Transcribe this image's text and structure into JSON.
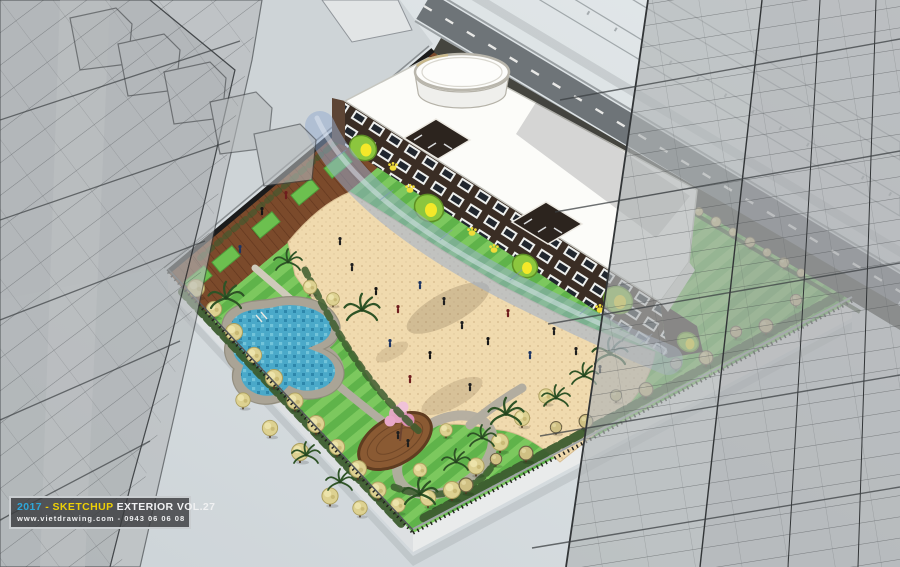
{
  "watermark": {
    "year": "2017",
    "separator": "-",
    "brand": "SKETCHUP",
    "series": "EXTERIOR VOL.27",
    "website": "www.vietdrawing.com",
    "separator2": "-",
    "phone": "0943 06 06 08"
  },
  "palette": {
    "sky_top": "#e3e8ea",
    "sky_bottom": "#cdd4d8",
    "lawn_a": "#5fb34a",
    "lawn_b": "#7cc85e",
    "sand": "#f0daae",
    "deck_wood": "#7b4a2b",
    "pool_water": "#4aa9c9",
    "pool_rim": "#aaa496",
    "roof_white": "#fcfcf9",
    "wall_brown": "#3a2d24",
    "window_frame": "#eef0ee",
    "window_glass": "#20262e",
    "blob_green": "#8cc63e",
    "blob_yellow": "#f5e829",
    "paw_yellow": "#f0dc3a",
    "canopy_blue": "#96acd0",
    "hedge_green": "#3c5c2e",
    "tree_yellow": "#ddd191",
    "tree_tan": "#cfc083",
    "palm_green": "#2e5326",
    "blossom_pink": "#e8a8c8",
    "road_gray": "#6e7478",
    "tower_gray": "#a9adaf",
    "tower_line": "#3f4346",
    "fence_dark": "#1b1b1b",
    "wm_year": "#2da7da",
    "wm_accent": "#ecd006",
    "wm_text": "#f0f1f2"
  }
}
